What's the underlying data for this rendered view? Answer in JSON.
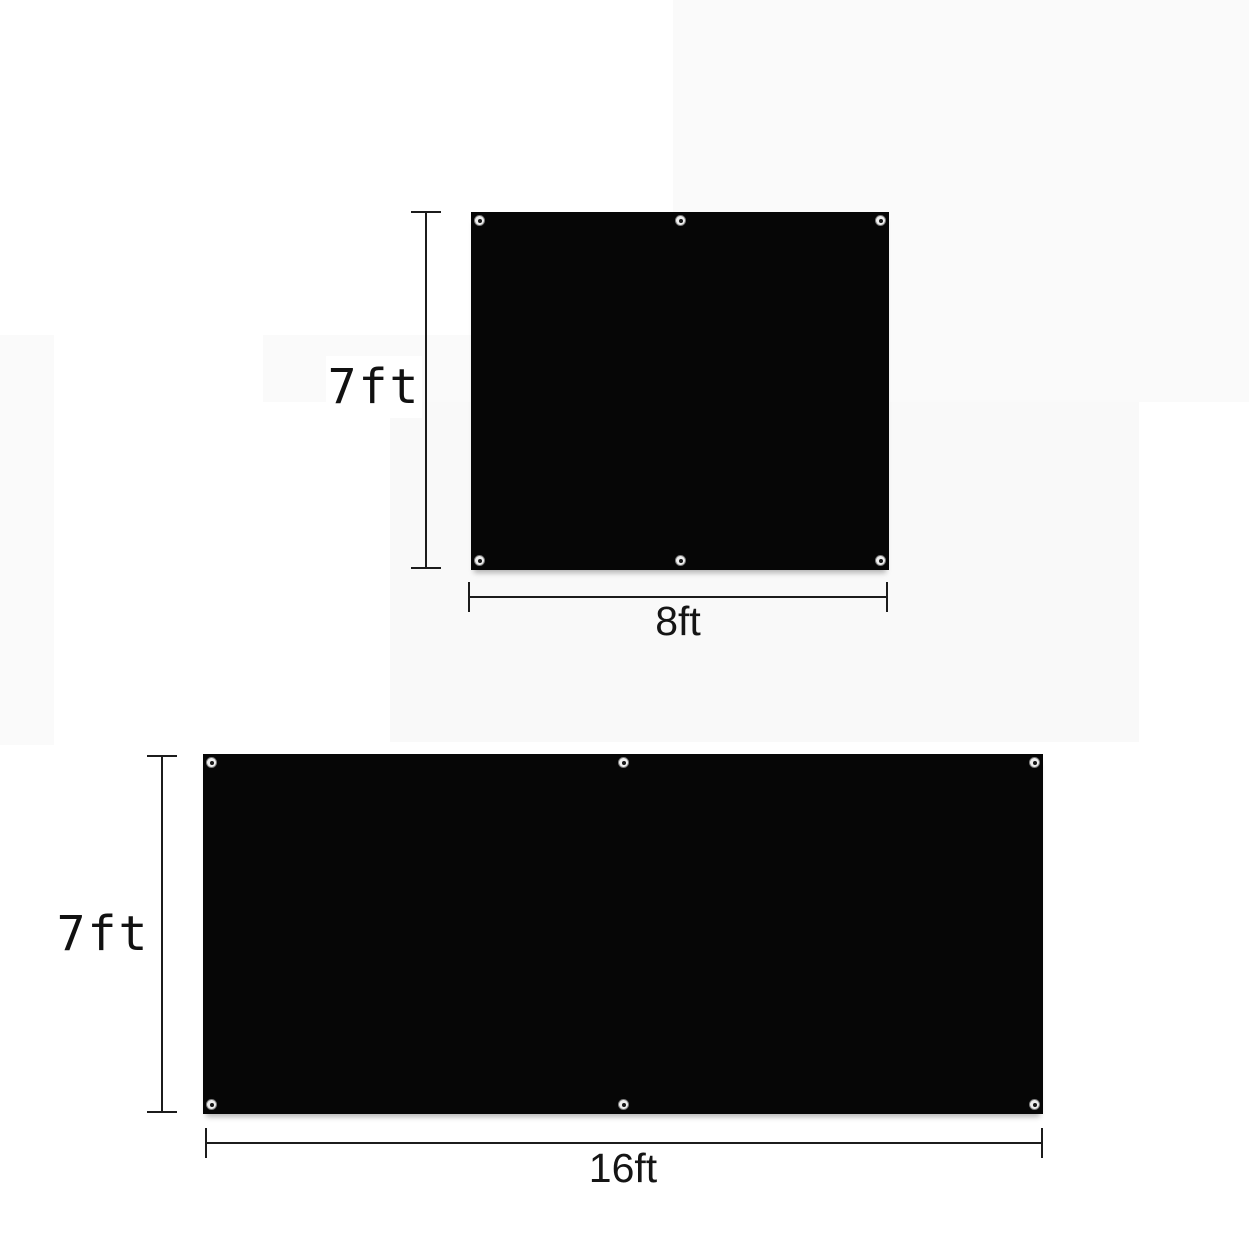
{
  "diagram": {
    "description": "Two black tarp panels with grommets and dimension callouts",
    "colors": {
      "tarp": "#060606",
      "dimension_line": "#1c1c1c",
      "label_text": "#111111",
      "background": "#ffffff"
    },
    "panels": [
      {
        "name": "panel-7x8",
        "height_label": "7ft",
        "width_label": "8ft",
        "grommet_count": 6
      },
      {
        "name": "panel-7x16",
        "height_label": "7ft",
        "width_label": "16ft",
        "grommet_count": 6
      }
    ]
  }
}
